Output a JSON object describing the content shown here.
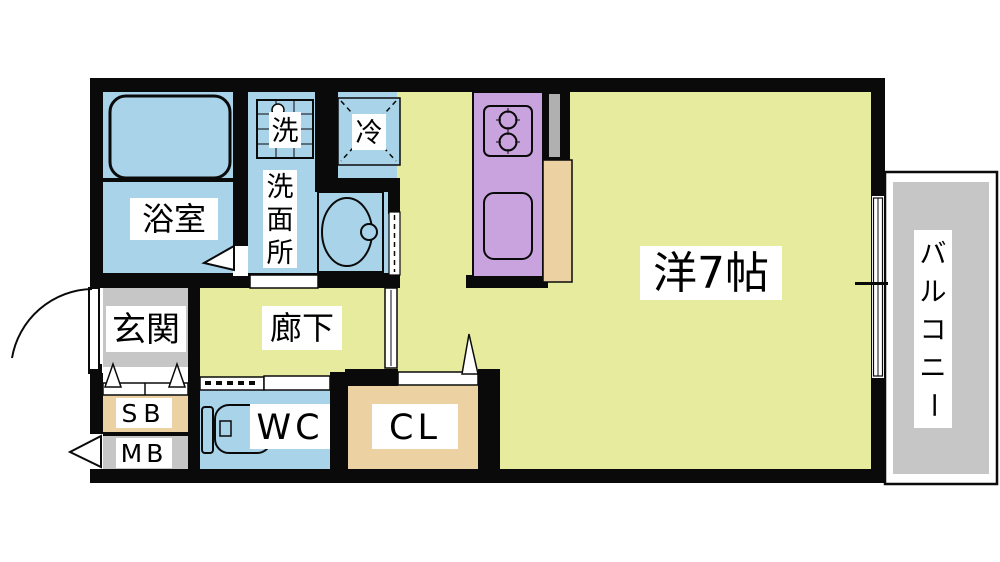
{
  "floorplan": {
    "labels": {
      "bathroom": "浴室",
      "laundry": "洗",
      "washroom": [
        "洗",
        "面",
        "所"
      ],
      "fridge": "冷",
      "entrance": "玄関",
      "corridor": "廊下",
      "main_room": "洋7帖",
      "balcony": [
        "バ",
        "ル",
        "コ",
        "ニ",
        "ー"
      ],
      "shoe_box": "SB",
      "meter_box": "MB",
      "toilet": "WC",
      "closet": "CL"
    },
    "colors": {
      "background": "#ffffff",
      "wall": "#0a0a0a",
      "floor": "#e7eb9d",
      "wet_area": "#a8d3e8",
      "kitchen_unit": "#c9a3dd",
      "storage": "#ecd2a2",
      "gray_area": "#c6c6c6",
      "pipe_space": "#b0b0b0"
    }
  }
}
